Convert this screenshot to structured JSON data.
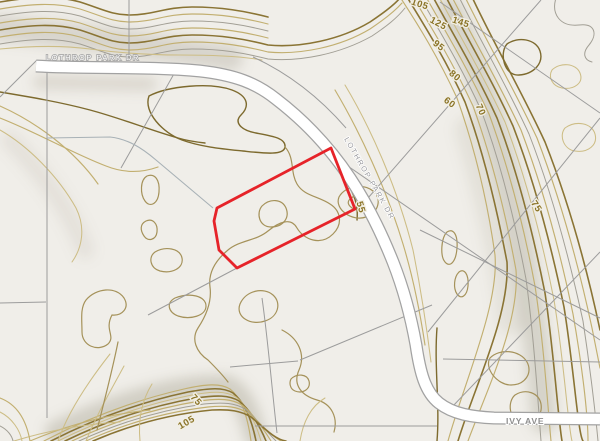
{
  "map": {
    "description": "Topographic parcel map with contours and highlighted parcel",
    "colors": {
      "background": "#f0eee9",
      "contour_index": "#8a7434",
      "contour_intermediate": "#c2af70",
      "parcel_line": "#9c9c9c",
      "road_fill": "#ffffff",
      "road_casing": "#a2a2a2",
      "highlight": "#e62329",
      "label_contour": "#8a7326"
    },
    "road_labels": [
      {
        "text": "LOTHROP PARK DR",
        "x": 46,
        "y": 60,
        "rotate": 0,
        "style": "lbl-road-light",
        "anchor": "start"
      },
      {
        "text": "LOTHROP PARK DR",
        "x": 344,
        "y": 139,
        "rotate": 60,
        "style": "lbl-road-gray",
        "anchor": "start"
      },
      {
        "text": "IVY AVE",
        "x": 506,
        "y": 424,
        "rotate": 0,
        "style": "lbl-road-gray-bold",
        "anchor": "start"
      }
    ],
    "contour_labels": [
      {
        "text": "105",
        "x": 419,
        "y": 7,
        "rotate": 18
      },
      {
        "text": "125",
        "x": 437,
        "y": 26,
        "rotate": 28
      },
      {
        "text": "145",
        "x": 460,
        "y": 25,
        "rotate": 18
      },
      {
        "text": "95",
        "x": 437,
        "y": 48,
        "rotate": 38
      },
      {
        "text": "80",
        "x": 453,
        "y": 78,
        "rotate": 40
      },
      {
        "text": "60",
        "x": 448,
        "y": 105,
        "rotate": 36
      },
      {
        "text": "70",
        "x": 478,
        "y": 111,
        "rotate": 66
      },
      {
        "text": "55",
        "x": 358,
        "y": 208,
        "rotate": 74
      },
      {
        "text": "75",
        "x": 534,
        "y": 208,
        "rotate": 56
      },
      {
        "text": "75",
        "x": 194,
        "y": 402,
        "rotate": 48
      },
      {
        "text": "105",
        "x": 188,
        "y": 425,
        "rotate": -30
      }
    ],
    "highlight_parcel": {
      "points": "331,148 355,209 237,268 219,250 214,221 217,208",
      "color": "#e62329"
    }
  }
}
